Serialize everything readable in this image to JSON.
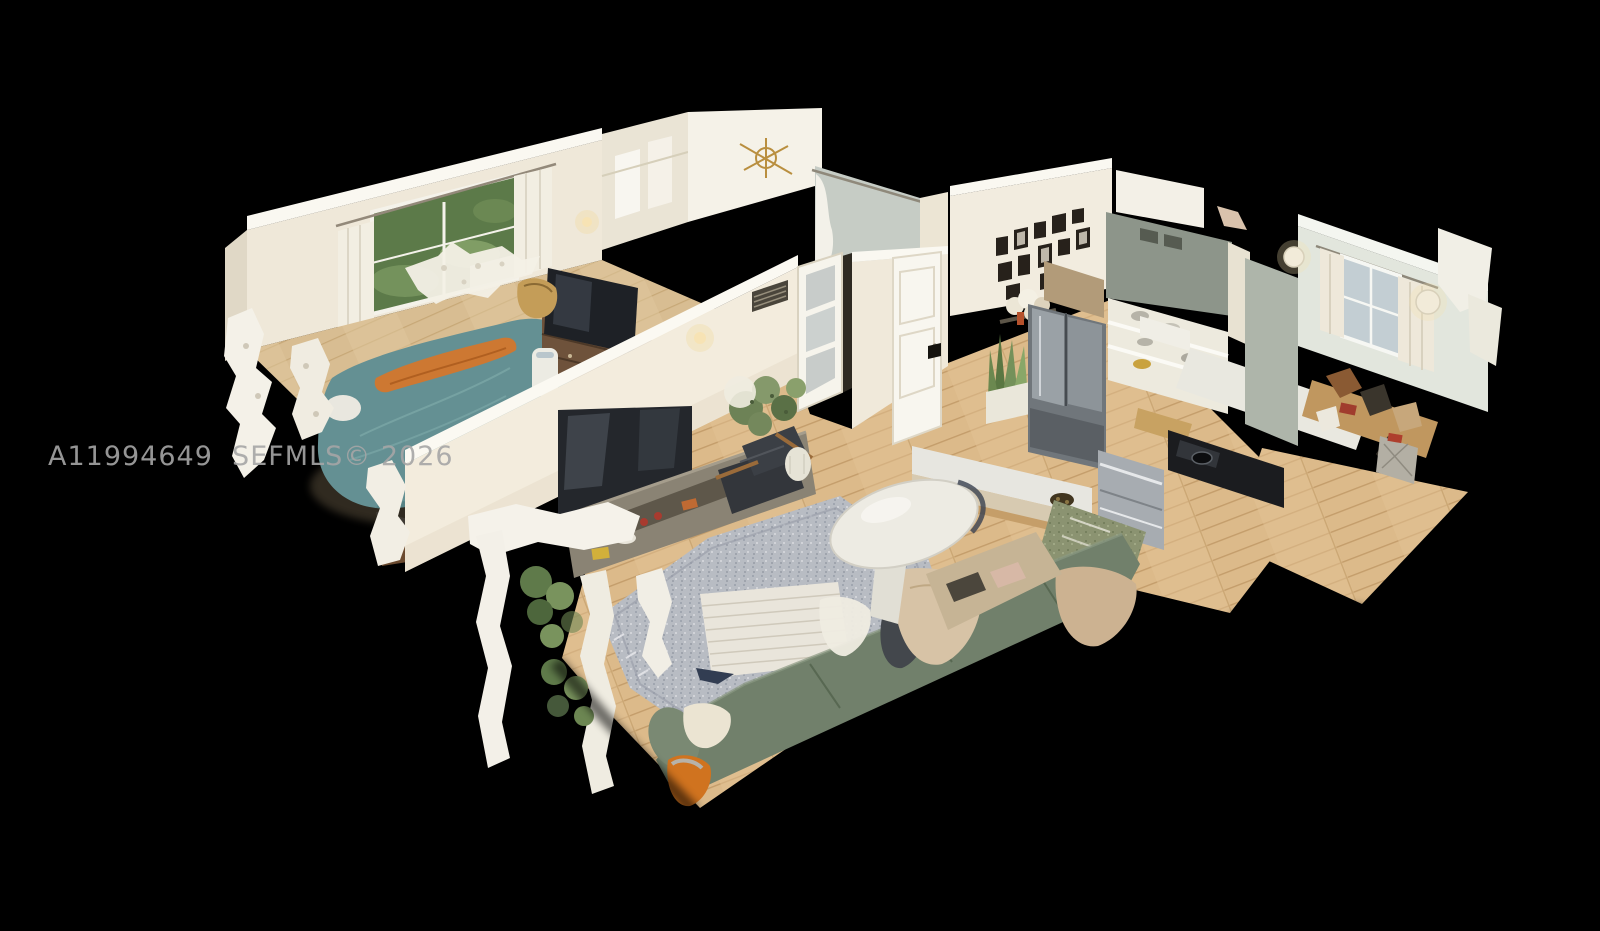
{
  "meta": {
    "type": "3d-dollhouse-scan",
    "description": "Overhead cutaway dollhouse view of a furnished apartment 3D scan (Matterport-style) floating on a black background",
    "background_color": "#000000"
  },
  "watermark": {
    "full_text": "A11994649  SEFMLS© 2026",
    "listing_id": "A11994649",
    "mls_label": "SEFMLS© 2026",
    "color": "#a6a6a6"
  },
  "palette": {
    "background": "#000000",
    "wall_cream": "#f1ebdd",
    "wall_cut_top": "#fbf9f2",
    "wall_sage": "#aeb5aa",
    "bedroom2_wall": "#e2e6dd",
    "wood_floor": "#dcba8a",
    "bedroom_floor": "#d8bd92",
    "area_rug": "#b8bcc3",
    "kitchen_rug": "#8b9371",
    "sofa_green": "#71806b",
    "bed_teal": "#649093",
    "blanket_orange": "#cd7832",
    "tv_black": "#24272c",
    "appliance_steel": "#9aa1a6",
    "counter_black": "#1b1c1f",
    "dresser_wood": "#6e523b",
    "plant_green": "#6d8256"
  },
  "scene": {
    "rooms": [
      {
        "name": "bedroom",
        "items": [
          "teal duvet bed",
          "orange blanket",
          "window with garden view",
          "curtains",
          "ceiling fan",
          "dresser with tv",
          "air purifier",
          "duffel bag"
        ]
      },
      {
        "name": "bathroom",
        "items": [
          "shower with curtain",
          "gold chandelier",
          "vent grille"
        ]
      },
      {
        "name": "hallway",
        "items": [
          "french door with frosted panes",
          "closet"
        ]
      },
      {
        "name": "entry",
        "items": [
          "front door",
          "gallery wall of framed photos",
          "white flowers",
          "snake plant in white pot"
        ]
      },
      {
        "name": "kitchen",
        "items": [
          "stainless french-door refrigerator",
          "gray range hood",
          "open shelving with dishes",
          "black cooktop counter",
          "stainless dishwasher",
          "white island peninsula",
          "green runner rug",
          "bananas on counter"
        ]
      },
      {
        "name": "living-room",
        "items": [
          "flat screen tv",
          "media console with decor",
          "leather armchair with wood arms",
          "house plants",
          "gray speckled area rug",
          "striped floor cushion",
          "sage green sofa with throw blankets",
          "orange bag"
        ]
      },
      {
        "name": "dining-area",
        "items": [
          "white oval pedestal table",
          "bench with pillows"
        ]
      },
      {
        "name": "second-bedroom",
        "items": [
          "window with curtains",
          "two round wall sconces",
          "cluttered desk",
          "woven basket",
          "dark media shelf"
        ]
      }
    ]
  }
}
